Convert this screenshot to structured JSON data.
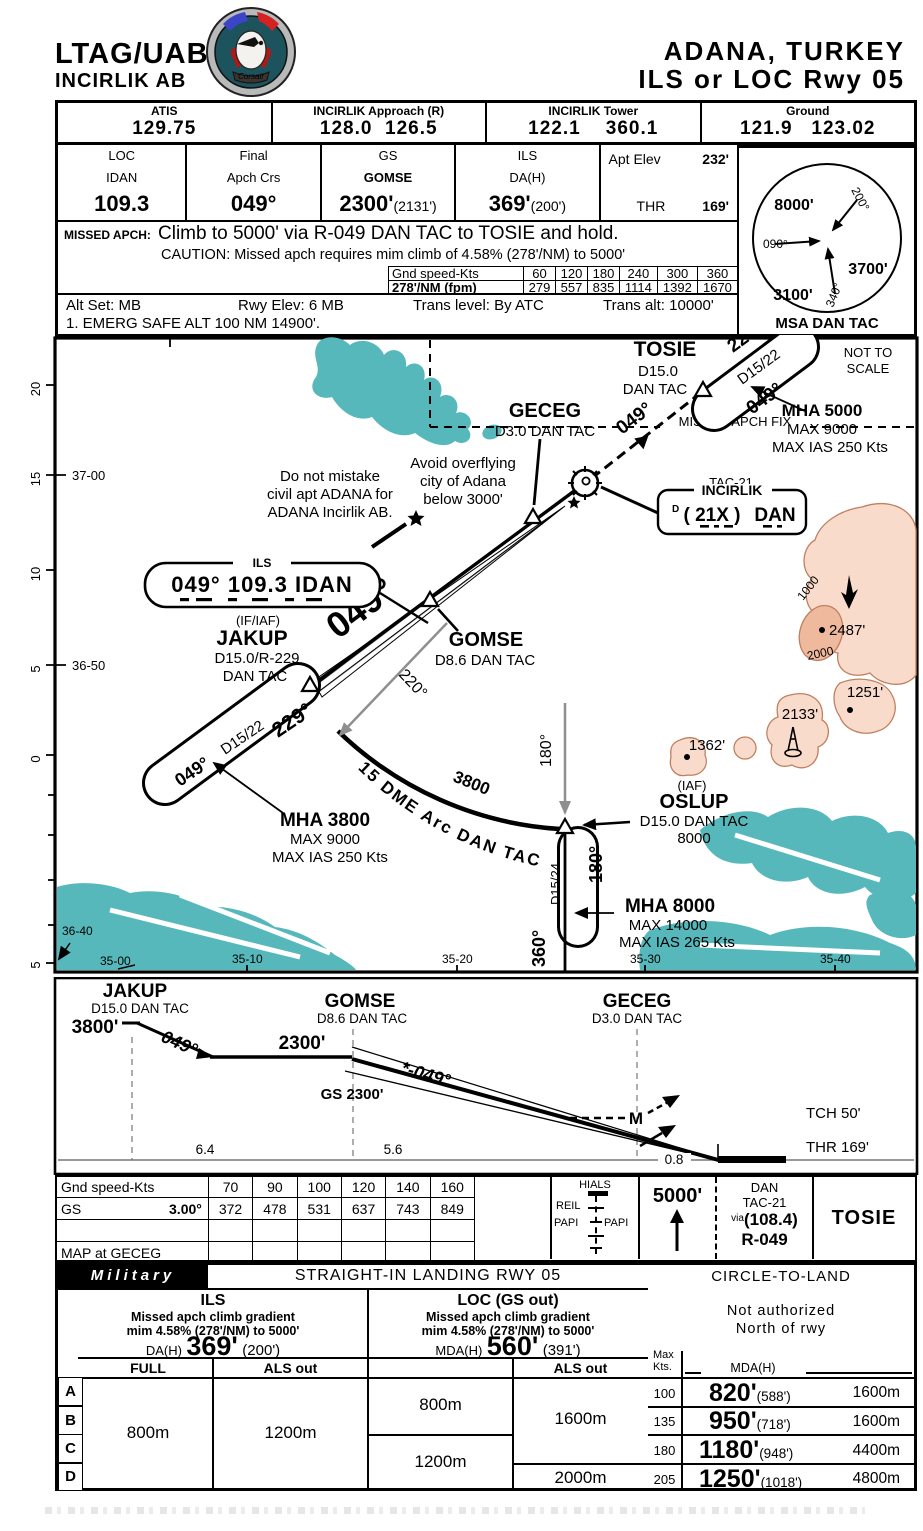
{
  "header": {
    "icao": "LTAG/UAB",
    "base": "INCIRLIK AB",
    "logo": "Corsair",
    "city": "ADANA, TURKEY",
    "proc": "ILS or LOC Rwy 05"
  },
  "comms": {
    "c1l": "ATIS",
    "c1v": "129.75",
    "c2l": "INCIRLIK Approach (R)",
    "c2v": "128.0  126.5",
    "c3l": "INCIRLIK Tower",
    "c3v": "122.1    360.1",
    "c4l": "Ground",
    "c4v": "121.9   123.02"
  },
  "databar": {
    "loc_l": "LOC",
    "loc_id": "IDAN",
    "loc_f": "109.3",
    "fin_l1": "Final",
    "fin_l2": "Apch Crs",
    "fin_v": "049°",
    "gs_l": "GS",
    "gs_fix": "GOMSE",
    "gs_v": "2300'",
    "gs_p": "(2131')",
    "ils_l": "ILS",
    "ils_l2": "DA(H)",
    "ils_v": "369'",
    "ils_p": "(200')",
    "apt_l": "Apt Elev",
    "apt_v": "232'",
    "thr_l": "THR",
    "thr_v": "169'"
  },
  "missed": {
    "label": "MISSED APCH:",
    "text": "Climb to 5000' via R-049 DAN TAC to TOSIE and hold.",
    "caution": "CAUTION: Missed apch requires mim climb of 4.58% (278'/NM) to 5000'",
    "t_l1": "Gnd speed-Kts",
    "t_s": [
      "60",
      "120",
      "180",
      "240",
      "300",
      "360"
    ],
    "t_l2": "278'/NM (fpm)",
    "t_f": [
      "279",
      "557",
      "835",
      "1114",
      "1392",
      "1670"
    ]
  },
  "settings": {
    "s1": "Alt Set: MB",
    "s2": "Rwy Elev: 6 MB",
    "s3": "Trans level: By ATC",
    "s4": "Trans alt: 10000'",
    "s5": "1. EMERG SAFE ALT 100 NM 14900'."
  },
  "msa": {
    "a1": "8000'",
    "a2": "3700'",
    "a3": "3100'",
    "r1": "090°",
    "r2": "200°",
    "r3": "340°",
    "label": "MSA DAN TAC"
  },
  "map": {
    "nts1": "NOT TO",
    "nts2": "SCALE",
    "maf": "MISSED APCH FIX",
    "tosie": {
      "name": "TOSIE",
      "d": "D15.0",
      "tac": "DAN TAC",
      "out": "229°",
      "leg": "D15/22",
      "inb": "049°",
      "mha": "MHA 5000",
      "max": "MAX 9000",
      "ias": "MAX IAS 250 Kts"
    },
    "navbox": {
      "tac": "TAC-21",
      "name": "INCIRLIK",
      "d": "D",
      "chan": "( 21X )",
      "id": "DAN"
    },
    "geceg": {
      "name": "GECEG",
      "d": "D3.0 DAN TAC"
    },
    "note1a": "Do not mistake",
    "note1b": "civil apt ADANA for",
    "note1c": "ADANA Incirlik AB.",
    "note2a": "Avoid overflying",
    "note2b": "city of Adana",
    "note2c": "below 3000'",
    "ilsbox": {
      "tag": "ILS",
      "text": "049° 109.3 IDAN"
    },
    "crs_dash": "049°",
    "crs_main": "049°",
    "jakup": {
      "iaf": "(IF/IAF)",
      "name": "JAKUP",
      "d": "D15.0/R-229",
      "tac": "DAN TAC",
      "inb": "049°",
      "leg": "D15/22",
      "out": "229°",
      "mha": "MHA 3800",
      "max": "MAX 9000",
      "ias": "MAX IAS 250 Kts"
    },
    "gomse": {
      "name": "GOMSE",
      "d": "D8.6 DAN TAC"
    },
    "arc": {
      "label": "15 DME Arc DAN TAC",
      "alt": "3800",
      "crs": "220°"
    },
    "oslup": {
      "grey": "180°",
      "iaf": "(IAF)",
      "name": "OSLUP",
      "d": "D15.0 DAN TAC",
      "alt": "8000",
      "leg": "D15/24",
      "inb": "180°",
      "out": "360°",
      "mha": "MHA 8000",
      "max": "MAX 14000",
      "ias": "MAX IAS 265 Kts"
    },
    "el1": "2487'",
    "el2": "2133'",
    "el3": "1362'",
    "el4": "1251'",
    "c1": "1000",
    "c2": "2000",
    "lat1": "37-00",
    "lat2": "36-50",
    "lat3": "36-40",
    "lon": [
      "35-00",
      "35-10",
      "35-20",
      "35-30",
      "35-40"
    ],
    "ruler": [
      "20",
      "15",
      "10",
      "5",
      "0",
      "5"
    ]
  },
  "profile": {
    "jak_n": "JAKUP",
    "jak_d": "D15.0 DAN TAC",
    "jak_a": "3800'",
    "jak_c": "049°",
    "lvl": "2300'",
    "gom_n": "GOMSE",
    "gom_d": "D8.6 DAN TAC",
    "gs_c": "*-049°",
    "gs_a": "GS 2300'",
    "gec_n": "GECEG",
    "gec_d": "D3.0 DAN TAC",
    "m": "M",
    "tch": "TCH 50'",
    "thr": "THR  169'",
    "d1": "6.4",
    "d2": "5.6",
    "d3": "0.8"
  },
  "strip": {
    "r1l": "Gnd speed-Kts",
    "r1": [
      "70",
      "90",
      "100",
      "120",
      "140",
      "160"
    ],
    "r2l": "GS",
    "r2a": "3.00°",
    "r2": [
      "372",
      "478",
      "531",
      "637",
      "743",
      "849"
    ],
    "r4l": "MAP at GECEG",
    "hials": "HIALS",
    "reil": "REIL",
    "papil": "PAPI",
    "papir": "PAPI",
    "ma_alt": "5000'",
    "via": "via",
    "nav1": "DAN",
    "nav2": "TAC-21",
    "navf": "(108.4)",
    "navr": "R-049",
    "fix": "TOSIE"
  },
  "minima": {
    "mil": "Military",
    "title": "STRAIGHT-IN LANDING RWY  05",
    "ils_t": "ILS",
    "ils_g1": "Missed apch climb gradient",
    "ils_g2": "mim 4.58% (278'/NM) to 5000'",
    "da_l": "DA(H)",
    "da": "369'",
    "da_p": "(200')",
    "loc_t": "LOC (GS out)",
    "loc_g1": "Missed apch climb gradient",
    "loc_g2": "mim 4.58% (278'/NM) to 5000'",
    "mda_l": "MDA(H)",
    "mda": "560'",
    "mda_p": "(391')",
    "full": "FULL",
    "als1": "ALS out",
    "als2": "ALS out",
    "cats": [
      "A",
      "B",
      "C",
      "D"
    ],
    "v_full": "800m",
    "v_als": "1200m",
    "v_loc1": "800m",
    "v_loc2": "1200m",
    "v_la1": "1600m",
    "v_la2": "2000m",
    "circle": {
      "title": "CIRCLE-TO-LAND",
      "n1": "Not authorized",
      "n2": "North of rwy",
      "mk1": "Max",
      "mk2": "Kts.",
      "mda": "MDA(H)",
      "rows": [
        {
          "k": "100",
          "m": "820'",
          "p": "(588')",
          "v": "1600m"
        },
        {
          "k": "135",
          "m": "950'",
          "p": "(718')",
          "v": "1600m"
        },
        {
          "k": "180",
          "m": "1180'",
          "p": "(948')",
          "v": "4400m"
        },
        {
          "k": "205",
          "m": "1250'",
          "p": "(1018')",
          "v": "4800m"
        }
      ]
    }
  }
}
